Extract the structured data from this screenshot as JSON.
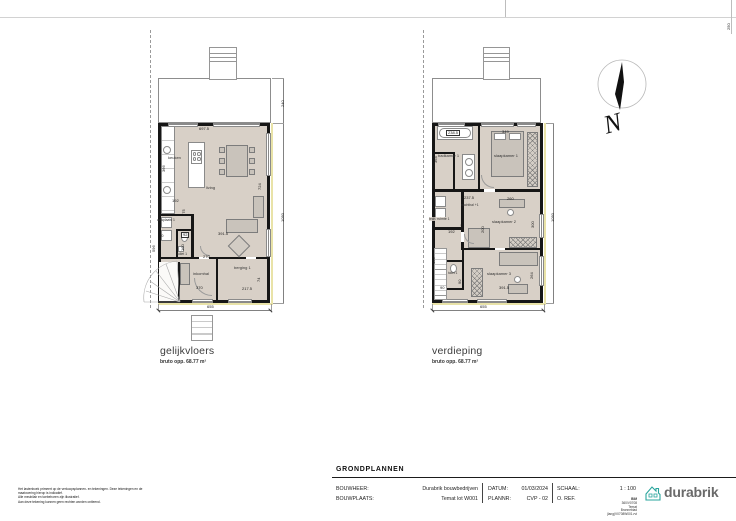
{
  "sheet": {
    "top_dim": "250"
  },
  "north": {
    "letter": "N"
  },
  "plan_ground": {
    "title": "gelijkvloers",
    "subtitle": "bruto opp. 68.77 m²",
    "rooms": {
      "keuken": "keuken",
      "living": "living",
      "wasplaats": "wasplaats 1",
      "toilet": "toilet 1",
      "inkomhal": "inkomhal",
      "berging": "berging 1"
    },
    "dims": {
      "d697_5": "697.5",
      "d366": "366",
      "d192": "192",
      "d175": "175",
      "d90": "90",
      "d92": "92",
      "d160": "160",
      "d596": "596",
      "d270": "270",
      "d370": "370",
      "d391_5": "391.5",
      "d217_5": "217.5",
      "d74": "74",
      "d724": "724",
      "d1050": "1050",
      "d240": "240",
      "d655": "655"
    }
  },
  "plan_floor": {
    "title": "verdieping",
    "subtitle": "bruto opp. 68.77 m²",
    "rooms": {
      "badkamer": "badkamer 1",
      "slaapkamer1": "slaapkamer 1",
      "nachthal": "nachthal +1",
      "tech": "tech. ruimte 1",
      "slaapkamer2": "slaapkamer 2",
      "slaapkamer3": "slaapkamer 3",
      "toilet": "toilet 1"
    },
    "dims": {
      "d238_5": "238.5",
      "d349": "349",
      "d364": "364",
      "d237_5": "237.5",
      "d192": "192",
      "d434": "434",
      "d200": "200",
      "d300": "300",
      "d260": "260",
      "d439": "439",
      "d90rot": "90",
      "d90": "90",
      "d391_5": "391.5",
      "d264": "264",
      "d1050": "1050",
      "d655": "655"
    }
  },
  "titleblock": {
    "sheet_title": "GRONDPLANNEN",
    "bouwheer_label": "BOUWHEER:",
    "bouwheer_value": "Durabrik bouwbedrijven",
    "bouwplaats_label": "BOUWPLAATS:",
    "bouwplaats_value": "Temat lot W001",
    "datum_label": "DATUM:",
    "datum_value": "01/03/2024",
    "plannr_label": "PLANNR:",
    "plannr_value": "CVP - 02",
    "schaal_label": "SCHAAL:",
    "schaal_value": "1 : 100",
    "oref_label": "O. REF.",
    "logo_text": "durabrik",
    "file_ref_lines": [
      "BIM",
      "360/V0708",
      "Temat",
      "Bronneblad",
      "(lang)V0708W001.rvt"
    ]
  },
  "disclaimer": {
    "line1": "Het lastenboek primeert op de verkoopsplannen- en tekeningen. Deze tekeningen en de maatvoering hierop is indicatief.",
    "line2": "Alle meubilair en toebehoren zijn illustratief.",
    "line3": "Aan deze tekening kunnen geen rechten worden ontleend."
  }
}
